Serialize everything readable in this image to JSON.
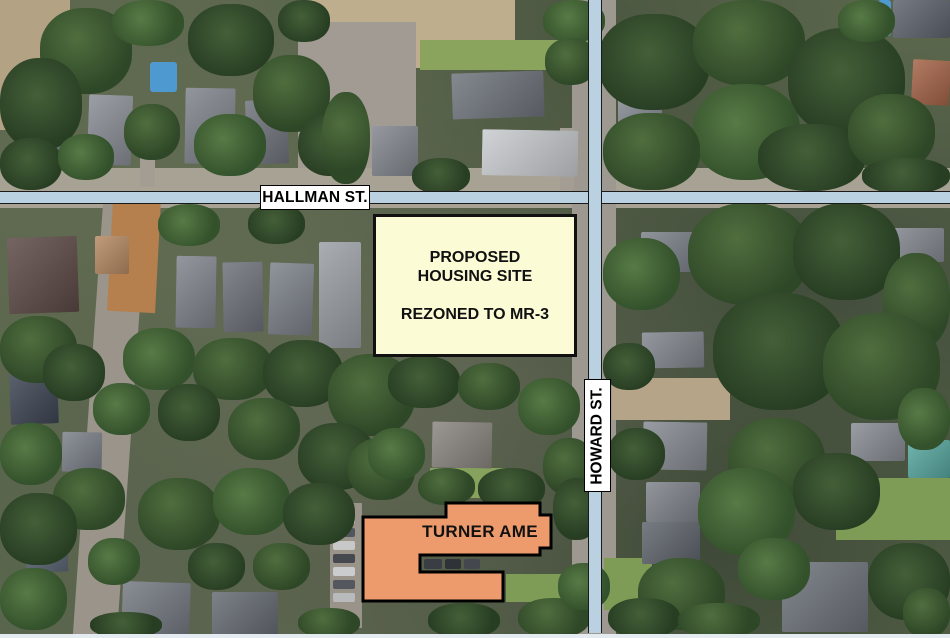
{
  "map": {
    "streets": {
      "hallman": {
        "label": "HALLMAN ST.",
        "orientation": "horizontal"
      },
      "howard": {
        "label": "HOWARD ST.",
        "orientation": "vertical"
      }
    },
    "annotations": {
      "proposed_site": {
        "line1": "PROPOSED",
        "line2": "HOUSING SITE",
        "line3": "REZONED TO MR-3",
        "fill": "#fbfbd6"
      },
      "turner_ame": {
        "label": "TURNER AME",
        "fill": "#ed9b6d"
      }
    },
    "colors": {
      "street_band": "#b9d1e0",
      "label_background": "#ffffff",
      "outline": "#000000"
    }
  }
}
